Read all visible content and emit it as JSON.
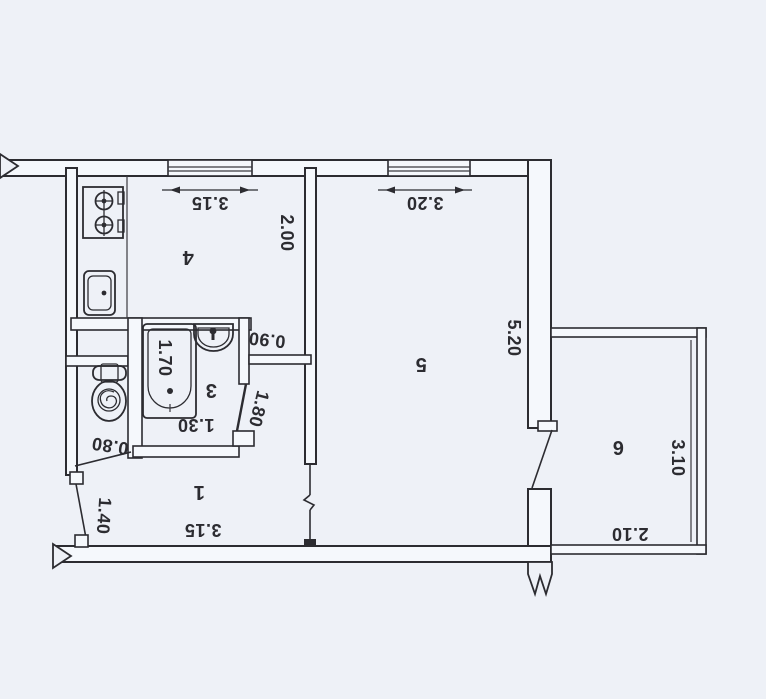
{
  "palette": {
    "paper": "#eef1f7",
    "wall_fill": "#f5f8fc",
    "ink": "#2c2c31"
  },
  "plan_type": "apartment-floor-plan-scan",
  "rooms": [
    {
      "number": "1",
      "dims": {
        "width": "3.15",
        "entry": "1.40"
      }
    },
    {
      "number": "3",
      "dims": {
        "tub": "1.70",
        "width": "1.30",
        "door_wall": "1.80",
        "door": "0.90",
        "wc_width": "0.80"
      }
    },
    {
      "number": "4",
      "dims": {
        "width": "3.15",
        "depth": "2.00"
      }
    },
    {
      "number": "5",
      "dims": {
        "width": "3.20",
        "depth": "5.20"
      }
    },
    {
      "number": "6",
      "dims": {
        "length": "3.10",
        "width": "2.10"
      }
    }
  ]
}
